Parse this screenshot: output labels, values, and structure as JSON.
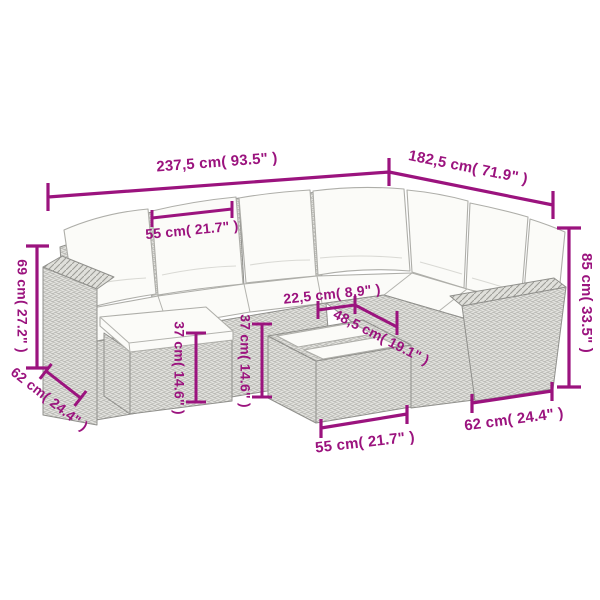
{
  "accent_color": "#9b137e",
  "diagram": {
    "subject": "corner-sofa-set-with-ottoman-and-coffee-table",
    "dimensions": {
      "top_width": "237,5 cm( 93.5\" )",
      "top_depth": "182,5 cm( 71.9\" )",
      "seat_width": "55 cm( 21.7\" )",
      "left_height": "69 cm( 27.2\" )",
      "left_base_depth": "62 cm( 24.4\" )",
      "ottoman_height": "37 cm( 14.6\" )",
      "table_height": "37 cm( 14.6\" )",
      "table_slat_width": "22,5 cm( 8.9\" )",
      "table_top_depth": "48,5 cm( 19.1\" )",
      "table_width": "55 cm( 21.7\" )",
      "right_base_depth": "62 cm( 24.4\" )",
      "total_height": "85 cm( 33.5\" )"
    }
  }
}
